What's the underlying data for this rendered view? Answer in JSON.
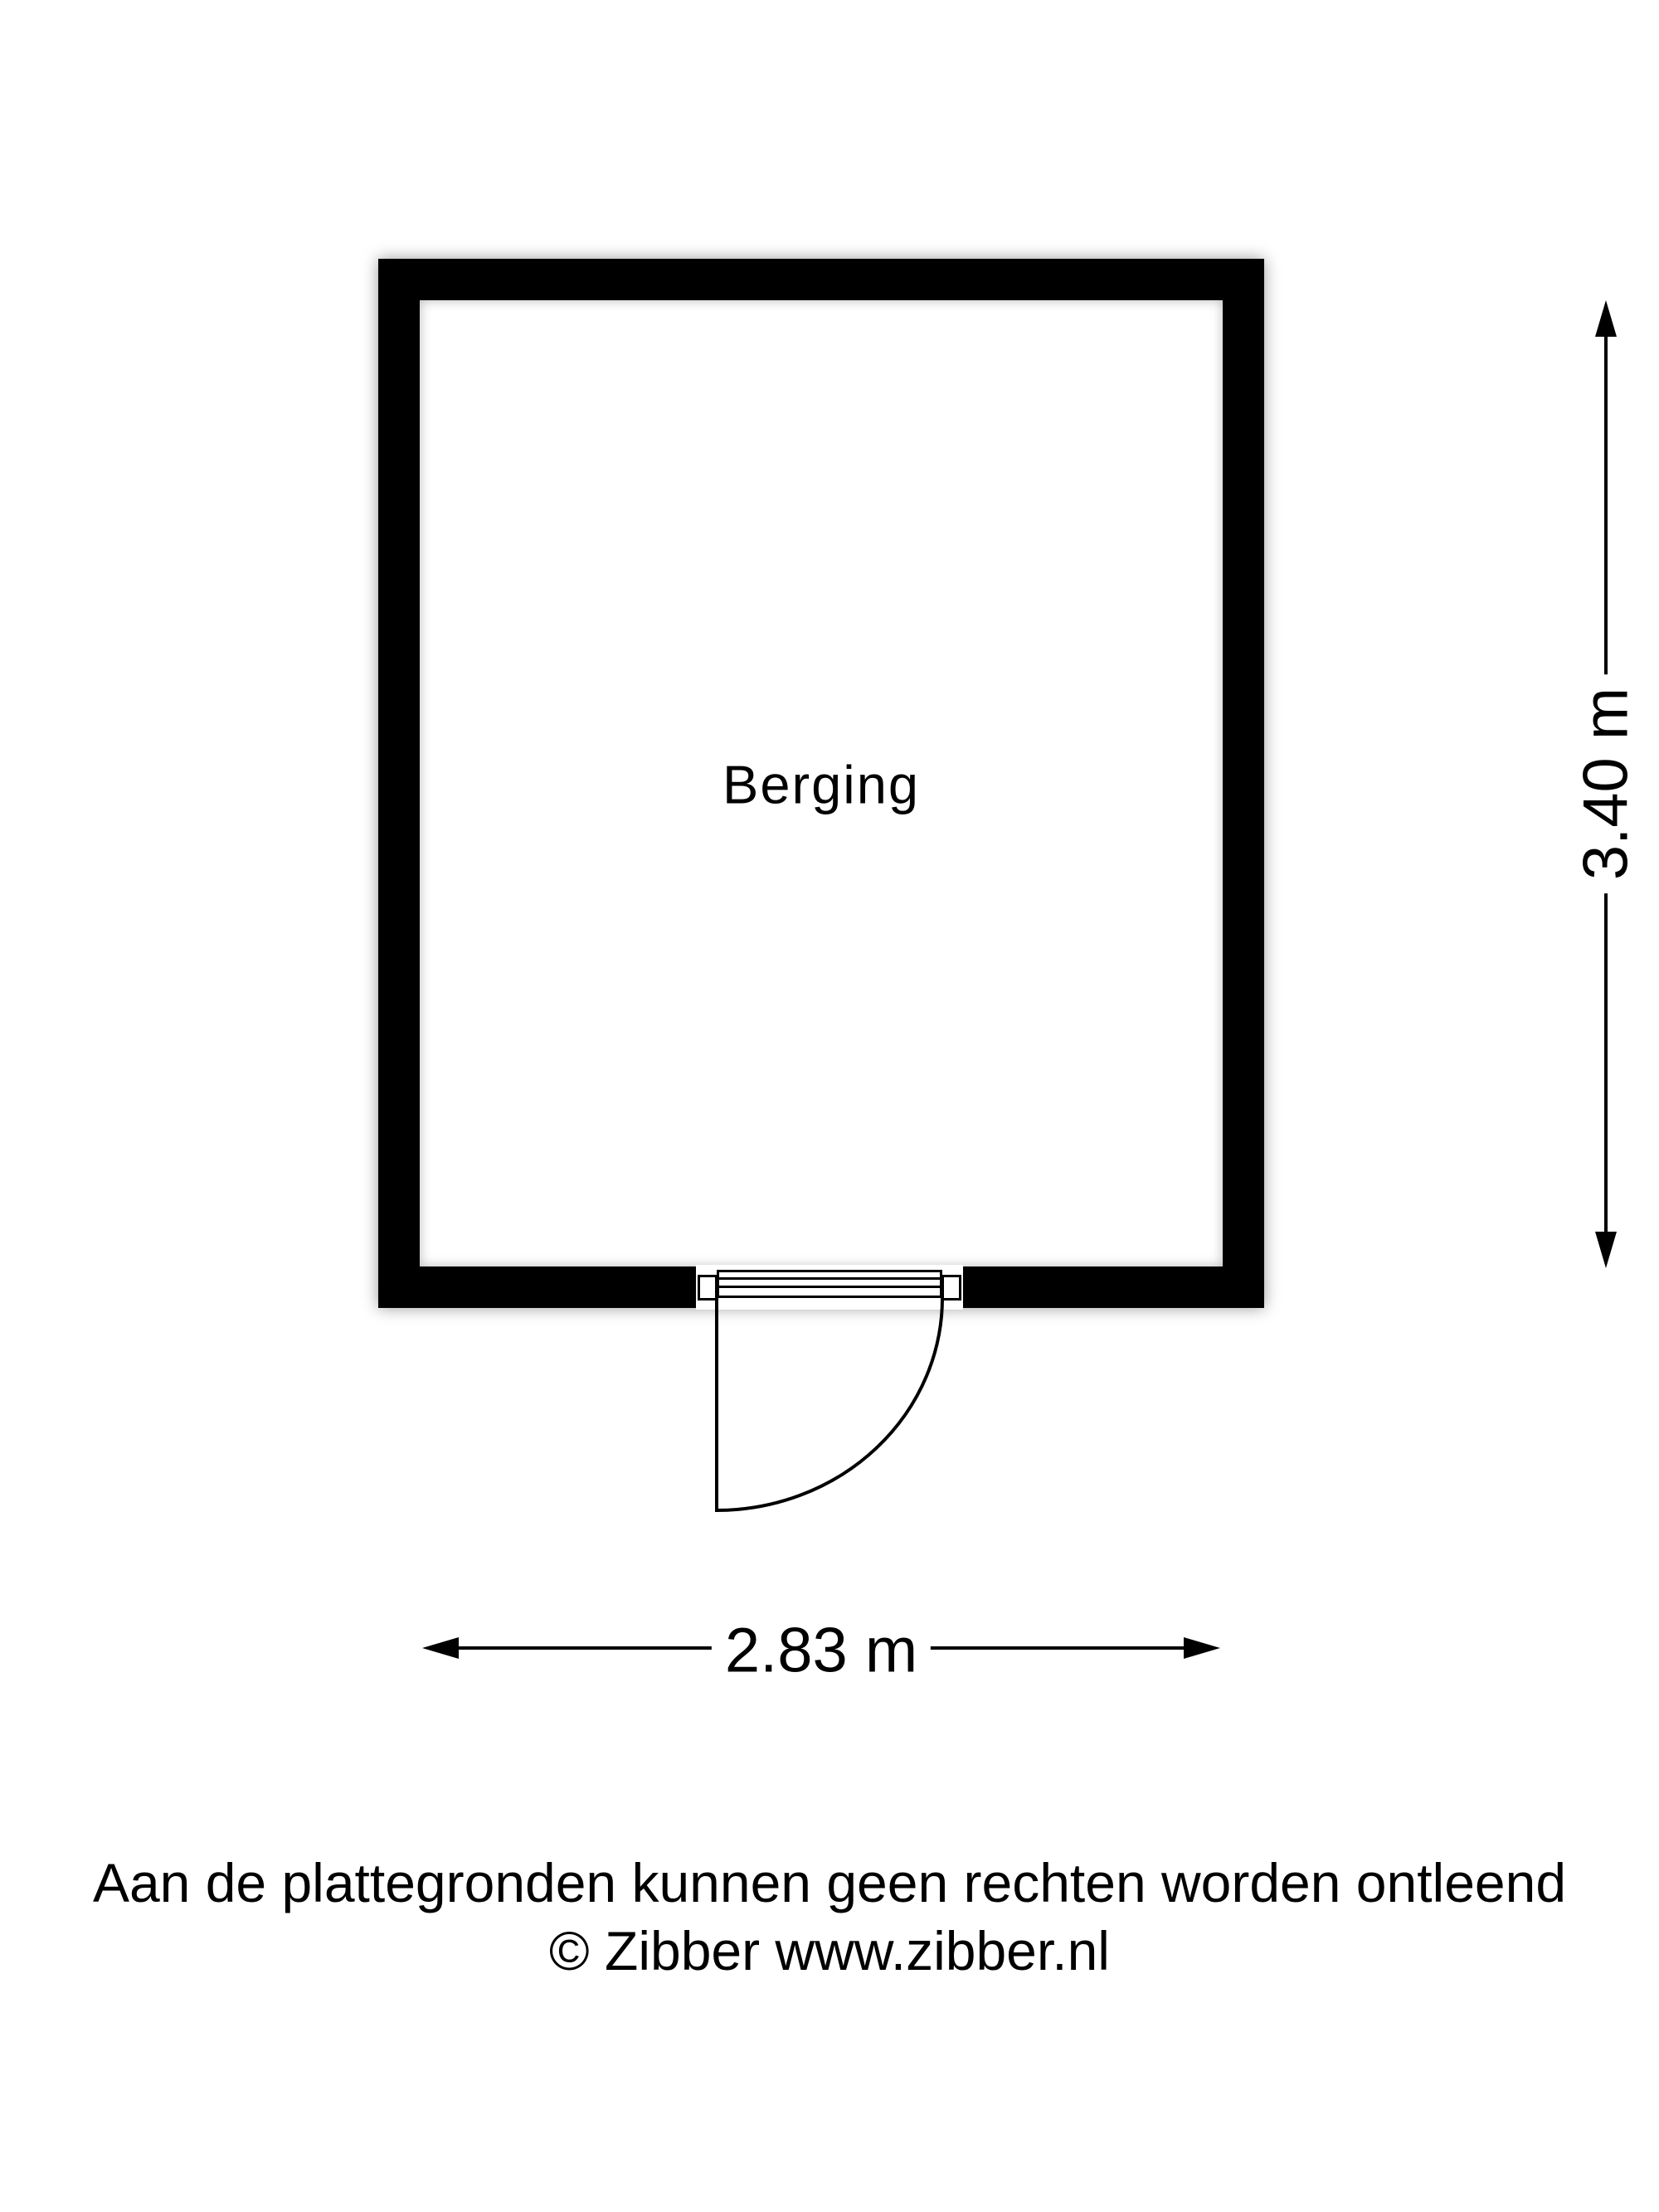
{
  "page": {
    "background": "#ffffff"
  },
  "floorplan": {
    "room": {
      "label": "Berging"
    },
    "dimensions": {
      "height": "3.40 m",
      "width": "2.83 m"
    },
    "colors": {
      "wall": "#000000",
      "line": "#000000",
      "text": "#000000",
      "background": "#ffffff"
    }
  },
  "footer": {
    "disclaimer": "Aan de plattegronden kunnen geen rechten worden ontleend",
    "copyright": "© Zibber www.zibber.nl"
  }
}
